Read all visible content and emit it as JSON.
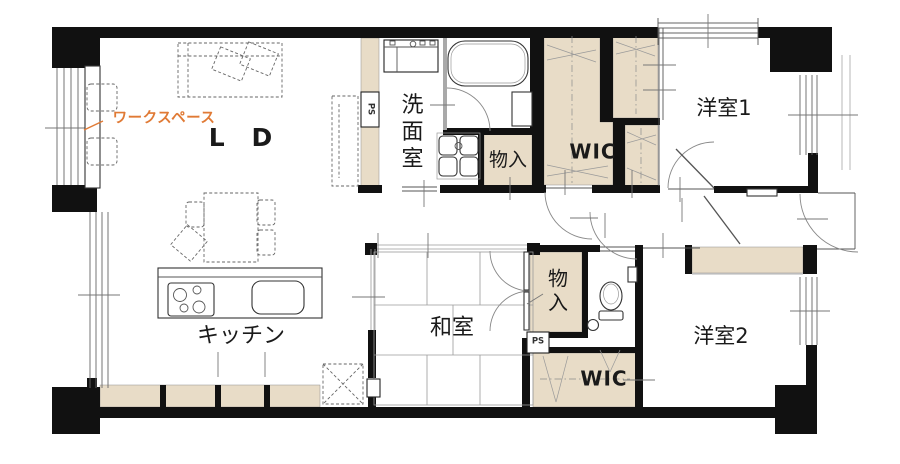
{
  "plan": {
    "type": "apartment-floor-plan",
    "annotation": {
      "workspace": "ワークスペース"
    },
    "rooms": {
      "living_dining": "L D",
      "kitchen": "キッチン",
      "japanese_room": "和室",
      "washroom": "洗面室",
      "western_room_1": "洋室1",
      "western_room_2": "洋室2"
    },
    "storage": {
      "closet_top": "物入",
      "closet_middle": "物入",
      "wic_top": "WIC",
      "wic_bottom": "WIC",
      "pipe_space_1": "PS",
      "pipe_space_2": "PS"
    },
    "colors": {
      "wall": "#111111",
      "storage_fill": "#e8dcc7",
      "accent": "#e07a35"
    }
  }
}
